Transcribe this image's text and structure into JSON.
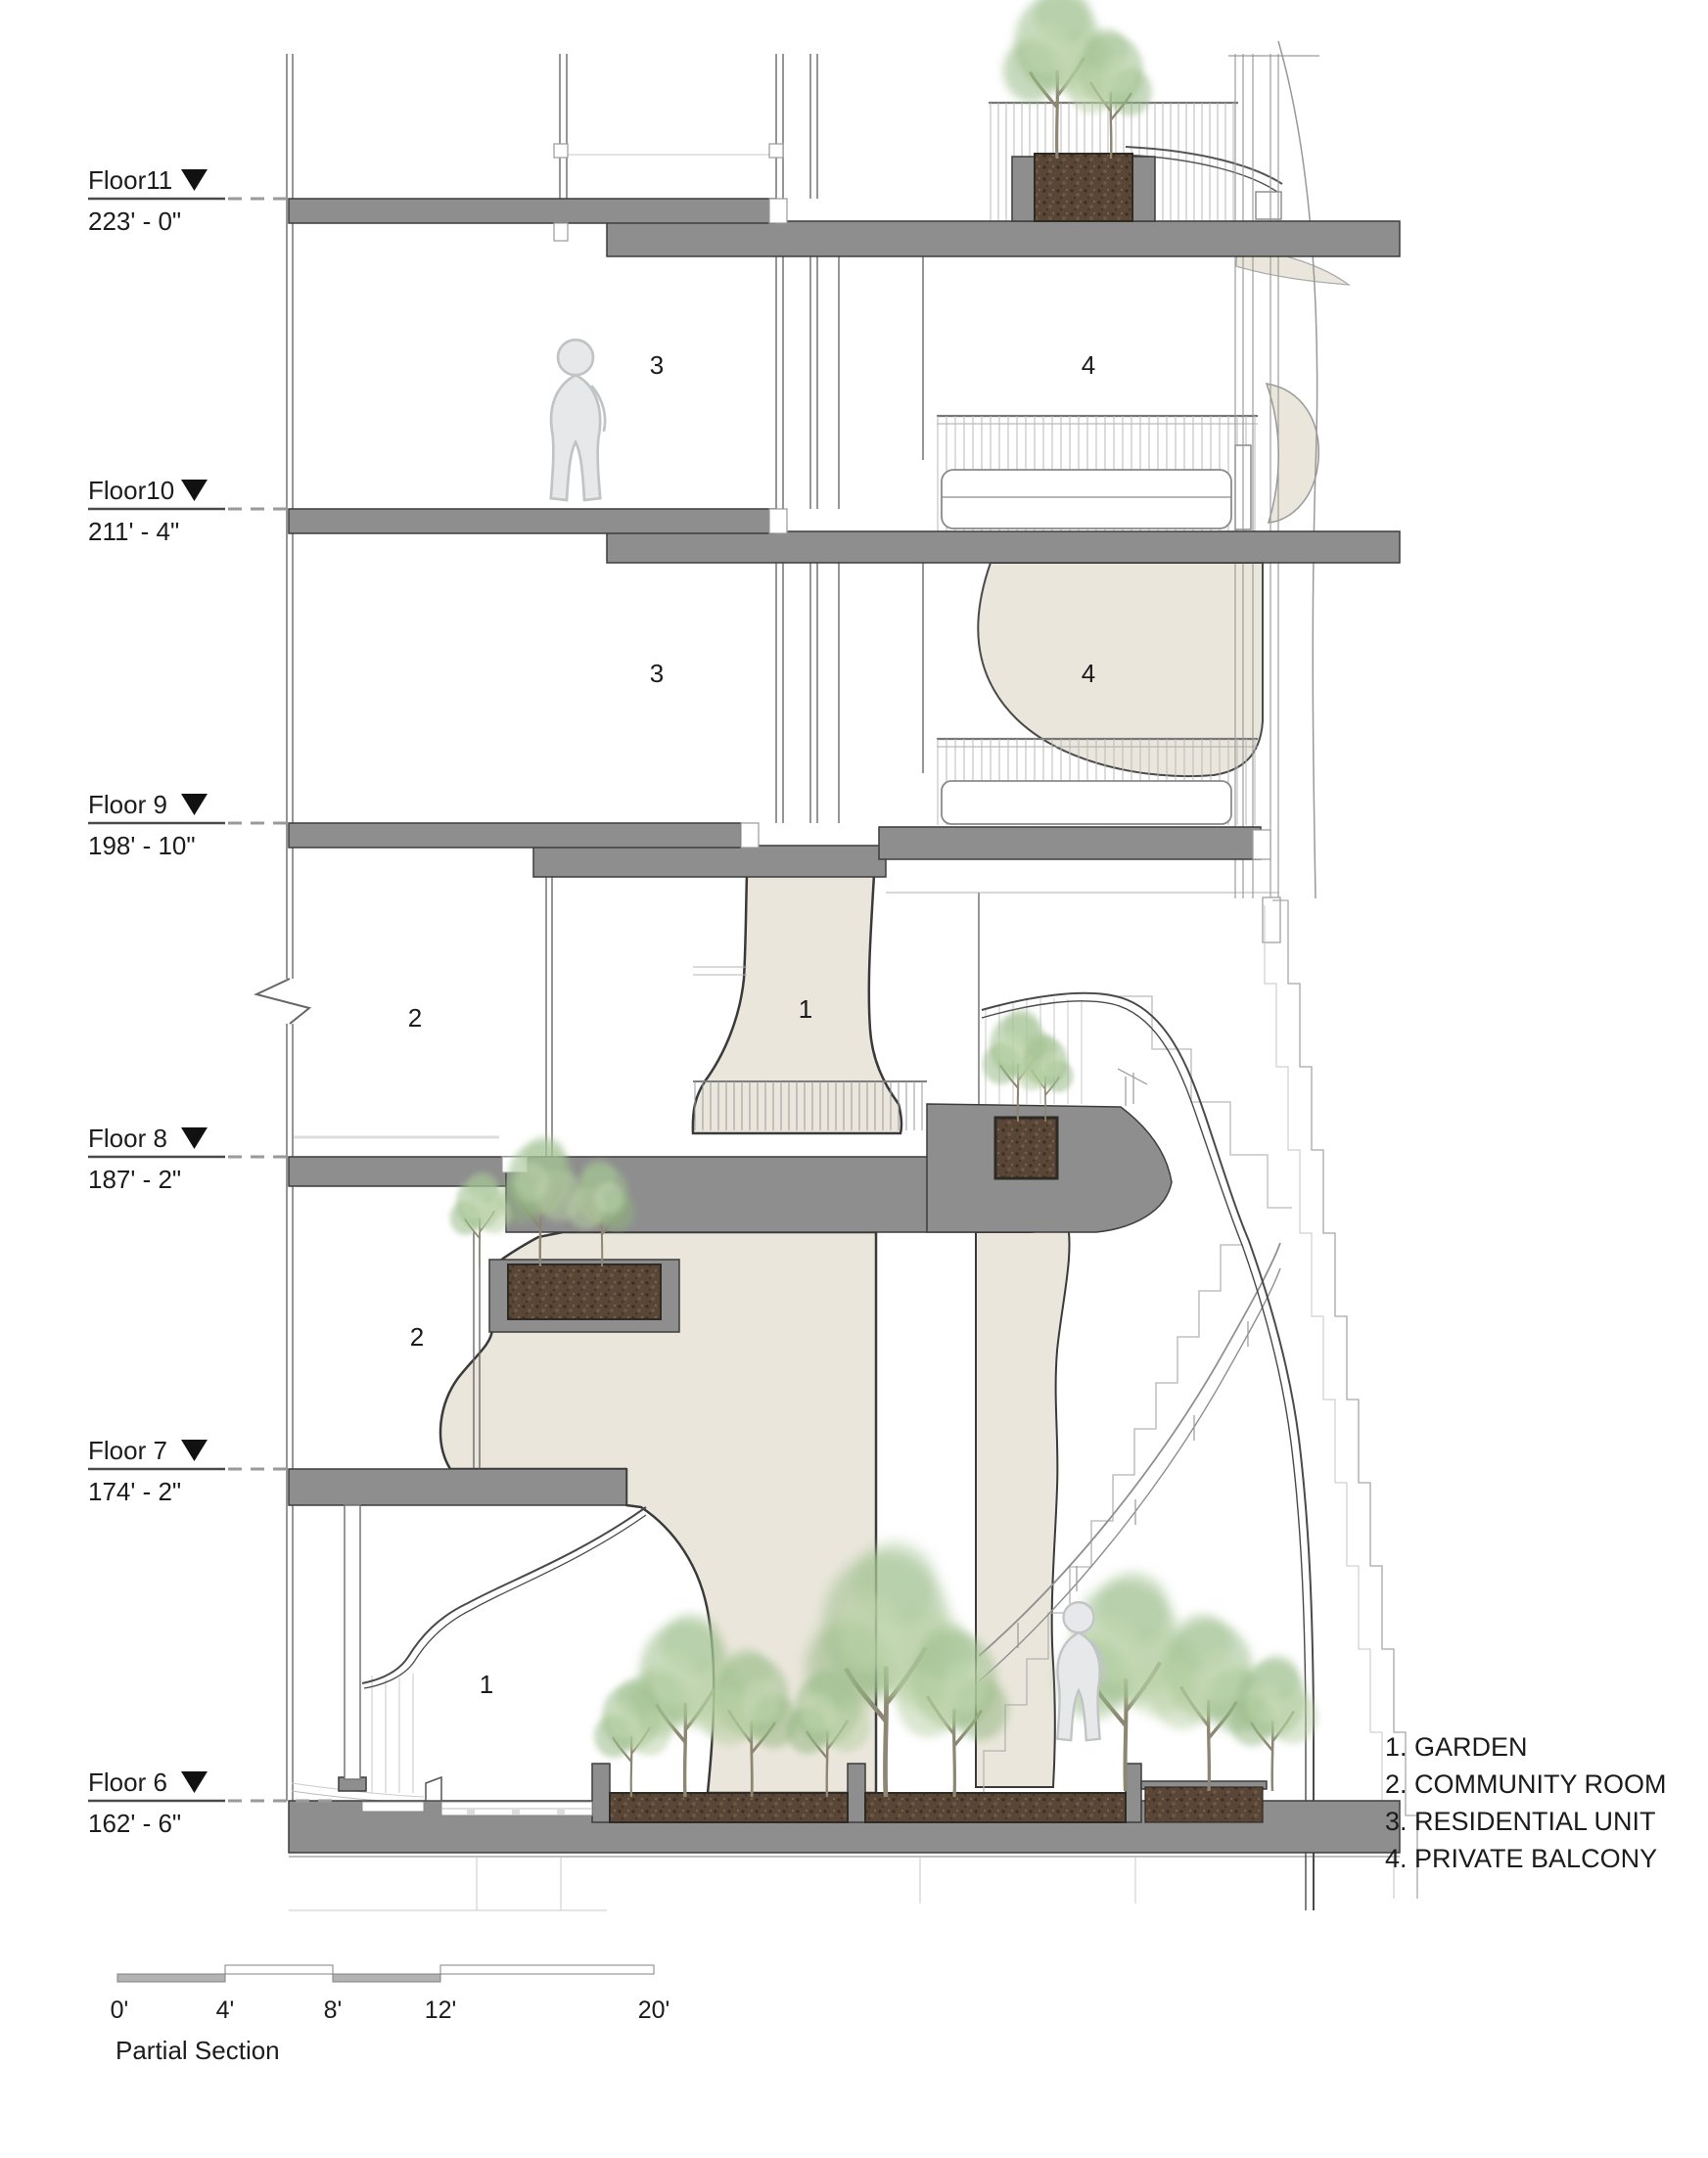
{
  "drawing": {
    "type": "architectural partial section",
    "floors": [
      {
        "label": "Floor11",
        "elevation": "223' - 0\""
      },
      {
        "label": "Floor10",
        "elevation": "211' - 4\""
      },
      {
        "label": "Floor 9",
        "elevation": "198' - 10\""
      },
      {
        "label": "Floor 8",
        "elevation": "187' - 2\""
      },
      {
        "label": "Floor 7",
        "elevation": "174' - 2\""
      },
      {
        "label": "Floor 6",
        "elevation": "162' - 6\""
      }
    ],
    "rooms": [
      {
        "value": "3"
      },
      {
        "value": "4"
      },
      {
        "value": "3"
      },
      {
        "value": "4"
      },
      {
        "value": "2"
      },
      {
        "value": "1"
      },
      {
        "value": "2"
      },
      {
        "value": "1"
      }
    ],
    "legend": {
      "items": [
        {
          "text": "1. GARDEN"
        },
        {
          "text": "2. COMMUNITY ROOM"
        },
        {
          "text": "3. RESIDENTIAL UNIT"
        },
        {
          "text": "4. PRIVATE BALCONY"
        }
      ]
    },
    "scale_bar": {
      "ticks": [
        "0'",
        "4'",
        "8'",
        "12'",
        "20'"
      ],
      "label": "Partial Section"
    },
    "colors": {
      "slab_gray": "#8e8e8e",
      "soil_brown": "#5a4637",
      "garden_beige": "#eae6db",
      "tree_green": "#9cbb8b",
      "outline": "#3a3a3a"
    }
  }
}
